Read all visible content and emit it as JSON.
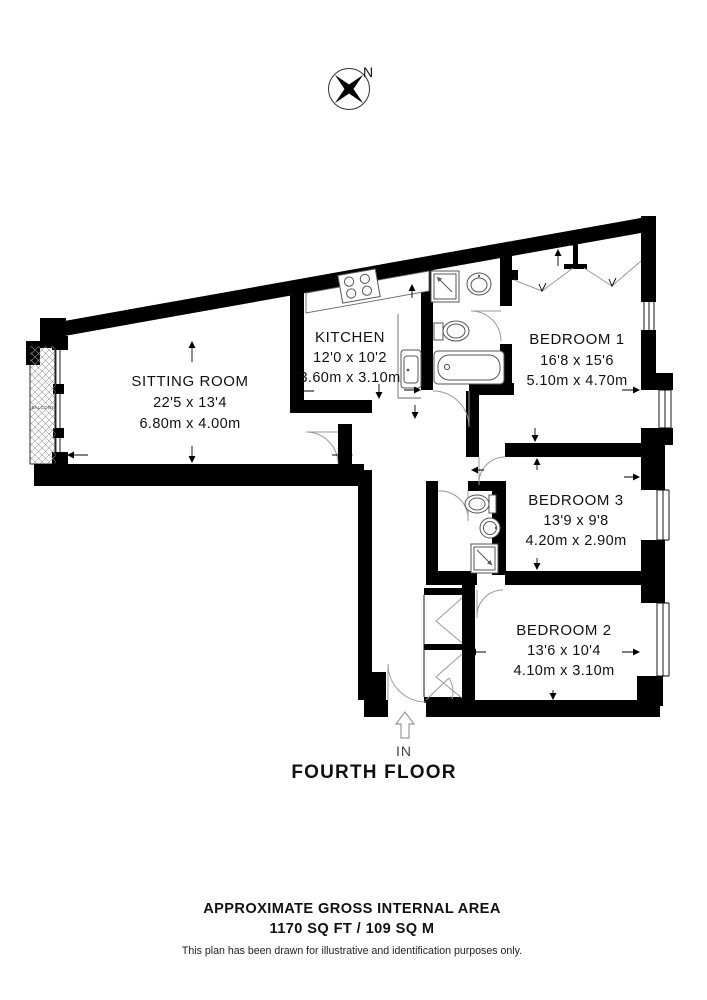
{
  "compass": {
    "north_label": "N"
  },
  "plan": {
    "floor_title": "FOURTH FLOOR",
    "entrance_label": "IN",
    "balcony_label": "BALCONY",
    "rooms": [
      {
        "name": "SITTING ROOM",
        "imperial": "22'5 x 13'4",
        "metric": "6.80m x 4.00m"
      },
      {
        "name": "KITCHEN",
        "imperial": "12'0 x 10'2",
        "metric": "3.60m x 3.10m"
      },
      {
        "name": "BEDROOM 1",
        "imperial": "16'8 x 15'6",
        "metric": "5.10m x 4.70m"
      },
      {
        "name": "BEDROOM 3",
        "imperial": "13'9 x 9'8",
        "metric": "4.20m x 2.90m"
      },
      {
        "name": "BEDROOM 2",
        "imperial": "13'6 x 10'4",
        "metric": "4.10m x 3.10m"
      }
    ]
  },
  "footer": {
    "area_title": "APPROXIMATE GROSS INTERNAL AREA",
    "area_value": "1170 SQ FT / 109 SQ M",
    "disclaimer": "This plan has been drawn for illustrative and identification purposes only."
  },
  "colors": {
    "wall": "#000000",
    "fixture_line": "#555555",
    "door_line": "#9a9a9a"
  }
}
